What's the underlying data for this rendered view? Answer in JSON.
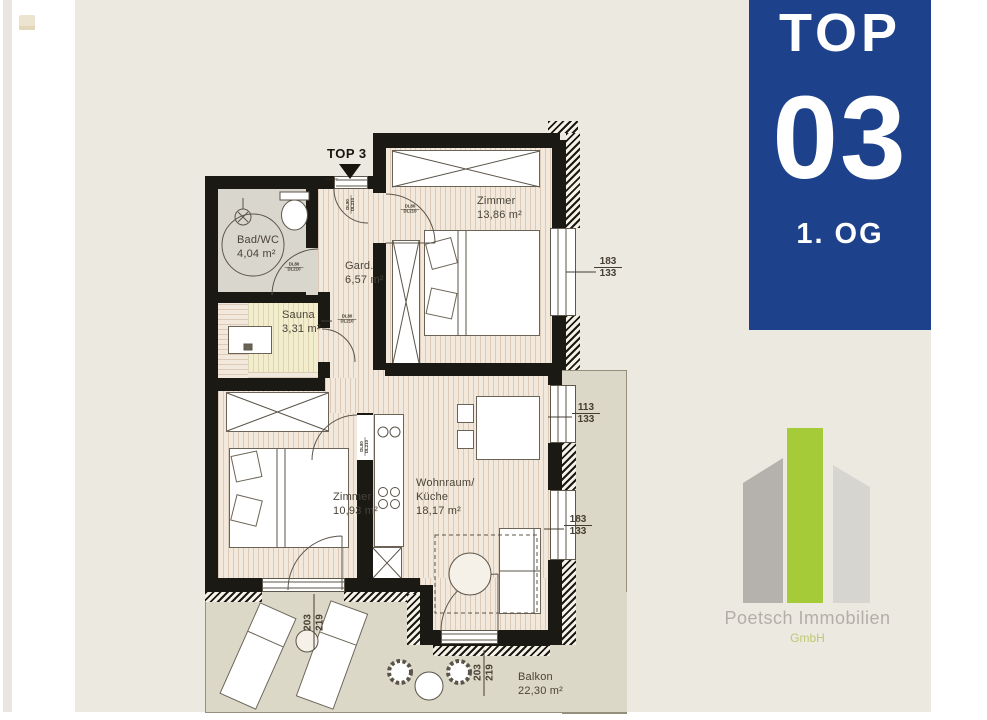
{
  "badge": {
    "top_label": "TOP",
    "unit_number": "03",
    "floor": "1. OG",
    "bg": "#1d428b"
  },
  "logo": {
    "company": "Poetsch Immobilien",
    "suffix": "GmbH",
    "bar_color": "#a5cb39"
  },
  "plan": {
    "entrance_marker": "TOP 3",
    "entrance_small_tag": "SW 80C",
    "rooms": [
      {
        "name": "Bad/WC",
        "area": "4,04 m²"
      },
      {
        "name": "Gard.",
        "area": "6,57 m²"
      },
      {
        "name": "Sauna",
        "area": "3,31 m²"
      },
      {
        "name": "Zimmer",
        "area": "13,86 m²"
      },
      {
        "name": "Zimmer",
        "area": "10,93 m²"
      },
      {
        "name": "Wohnraum/",
        "name_line2": "Küche",
        "area": "18,17 m²"
      },
      {
        "name": "Balkon",
        "area": "22,30 m²"
      }
    ],
    "window_dims": [
      {
        "w": "183",
        "h": "133"
      },
      {
        "w": "113",
        "h": "133"
      },
      {
        "w": "183",
        "h": "133"
      }
    ],
    "door_dims": [
      {
        "w": "203",
        "h": "219"
      },
      {
        "w": "203",
        "h": "219"
      }
    ],
    "door_tags": {
      "t80": "DL80",
      "t90": "DL90",
      "t210": "DL210"
    }
  }
}
